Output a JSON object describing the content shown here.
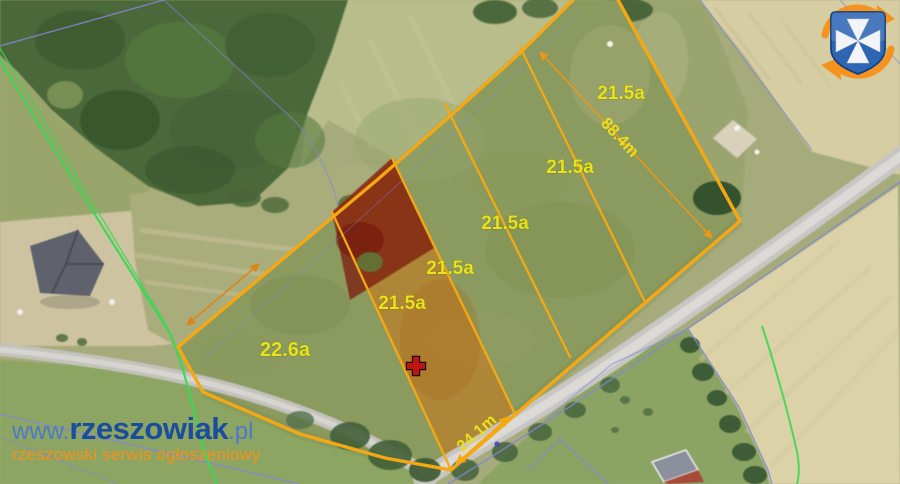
{
  "source": {
    "site_prefix": "www.",
    "site_name": "rzeszowiak",
    "site_tld": ".pl",
    "tagline": "rzeszowski serwis ogłoszeniowy",
    "logo": "rzeszow-crest-with-orange-swirl"
  },
  "map": {
    "type": "satellite-parcel-plan",
    "parcels": [
      {
        "area": "22.6a",
        "highlighted": false
      },
      {
        "area": "21.5a",
        "highlighted": true
      },
      {
        "area": "21.5a",
        "highlighted": false
      },
      {
        "area": "21.5a",
        "highlighted": false
      },
      {
        "area": "21.5a",
        "highlighted": false
      },
      {
        "area": "21.5a",
        "highlighted": false
      }
    ],
    "dimensions": [
      {
        "label": "88.4m"
      },
      {
        "label": "24.1m"
      }
    ],
    "marker": {
      "type": "red-cross"
    }
  },
  "colors": {
    "parcel_boundary": "#f5a813",
    "parcel_label": "#e9e319",
    "highlight_overlay": "#b96f22",
    "highlight_dark_red": "#7c150b",
    "watermark_light_blue": "#4e79cb",
    "watermark_dark_blue": "#1b4d9e",
    "watermark_orange": "#f6911a",
    "cadastral_line": "#8486d6",
    "survey_line_green": "#3bd755",
    "logo_orange": "#f6921e",
    "logo_blue": "#2f66b4"
  }
}
